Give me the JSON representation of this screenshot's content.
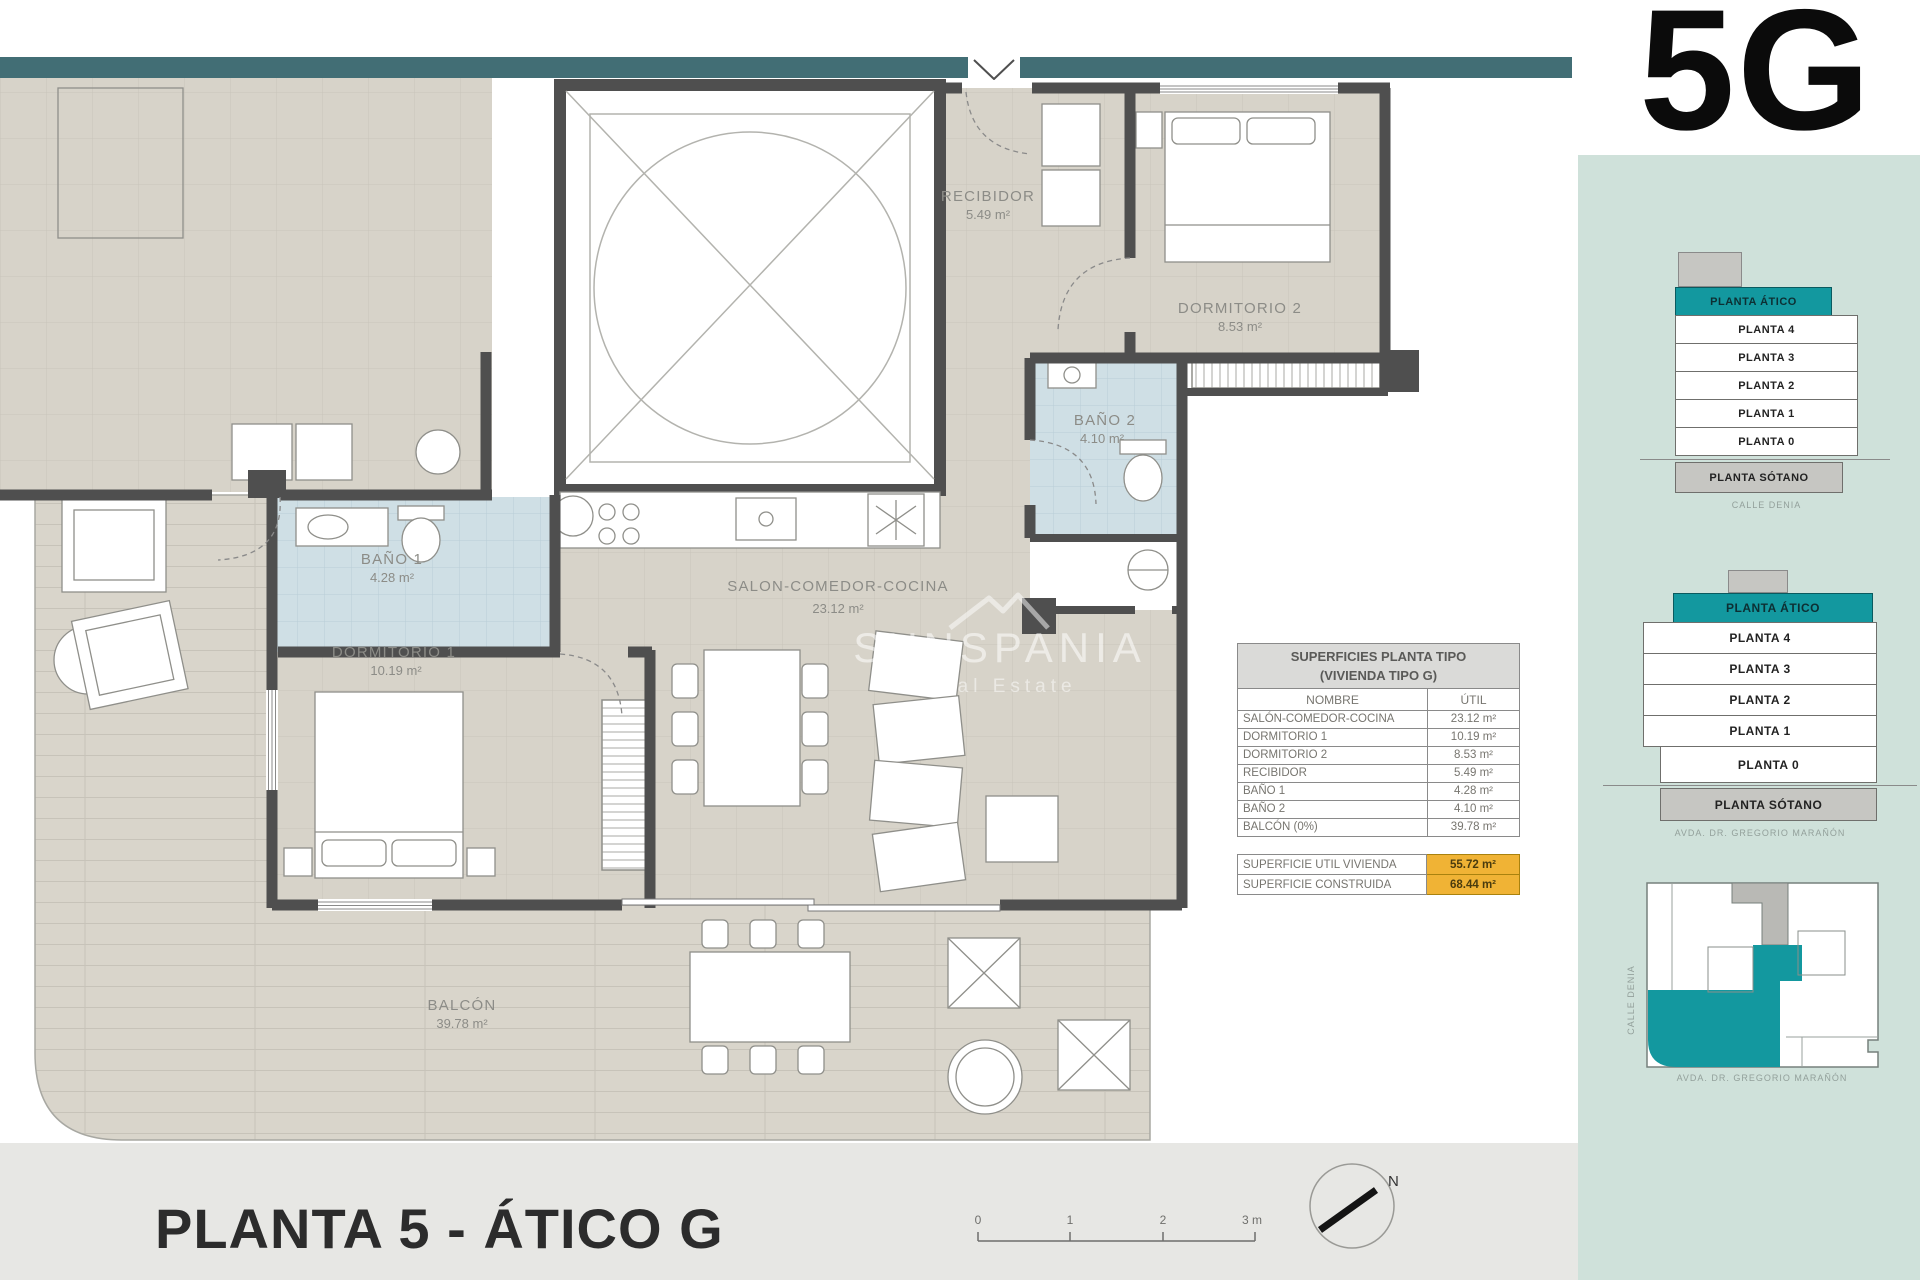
{
  "header": {
    "unit_code": "5G"
  },
  "footer": {
    "title": "PLANTA 5 - ÁTICO G"
  },
  "watermark": {
    "name": "SUNSPANIA",
    "tagline": "Real Estate"
  },
  "plan": {
    "north_label": "N",
    "scale": {
      "ticks": [
        "0",
        "1",
        "2",
        "3 m"
      ]
    },
    "rooms": {
      "recibidor": {
        "name": "RECIBIDOR",
        "area": "5.49 m²"
      },
      "dormitorio2": {
        "name": "DORMITORIO 2",
        "area": "8.53 m²"
      },
      "bano2": {
        "name": "BAÑO 2",
        "area": "4.10 m²"
      },
      "bano1": {
        "name": "BAÑO 1",
        "area": "4.28 m²"
      },
      "dormitorio1": {
        "name": "DORMITORIO 1",
        "area": "10.19 m²"
      },
      "salon": {
        "name": "SALON-COMEDOR-COCINA",
        "area": "23.12 m²"
      },
      "balcon": {
        "name": "BALCÓN",
        "area": "39.78 m²"
      }
    }
  },
  "surfaces_table": {
    "title_line1": "SUPERFICIES PLANTA TIPO",
    "title_line2": "(VIVIENDA TIPO G)",
    "col_name": "NOMBRE",
    "col_util": "ÚTIL",
    "rows": [
      {
        "name": "SALÓN-COMEDOR-COCINA",
        "util": "23.12 m²"
      },
      {
        "name": "DORMITORIO 1",
        "util": "10.19 m²"
      },
      {
        "name": "DORMITORIO 2",
        "util": "8.53 m²"
      },
      {
        "name": "RECIBIDOR",
        "util": "5.49 m²"
      },
      {
        "name": "BAÑO 1",
        "util": "4.28 m²"
      },
      {
        "name": "BAÑO 2",
        "util": "4.10 m²"
      },
      {
        "name": "BALCÓN (0%)",
        "util": "39.78 m²"
      }
    ],
    "totals": [
      {
        "name": "SUPERFICIE UTIL VIVIENDA",
        "value": "55.72 m²"
      },
      {
        "name": "SUPERFICIE CONSTRUIDA",
        "value": "68.44 m²"
      }
    ]
  },
  "sidebar": {
    "stacks": [
      {
        "floors": [
          "PLANTA ÁTICO",
          "PLANTA 4",
          "PLANTA 3",
          "PLANTA 2",
          "PLANTA 1",
          "PLANTA 0",
          "PLANTA SÓTANO"
        ],
        "caption": "CALLE DENIA"
      },
      {
        "floors": [
          "PLANTA ÁTICO",
          "PLANTA 4",
          "PLANTA 3",
          "PLANTA 2",
          "PLANTA 1",
          "PLANTA 0",
          "PLANTA SÓTANO"
        ],
        "caption": "AVDA. DR. GREGORIO MARAÑÓN"
      }
    ],
    "site_plan": {
      "street_left": "CALLE DENIA",
      "street_bottom": "AVDA. DR. GREGORIO MARAÑÓN"
    }
  },
  "colors": {
    "accent_teal": "#13989f",
    "top_bar": "#426e75",
    "sidebar_panel": "#cfe1da",
    "highlight_yellow": "#f0b335",
    "floor_beige": "#d7d3c9",
    "bath_blue": "#cfdfe5",
    "wall_gray": "#4f4f4f"
  }
}
